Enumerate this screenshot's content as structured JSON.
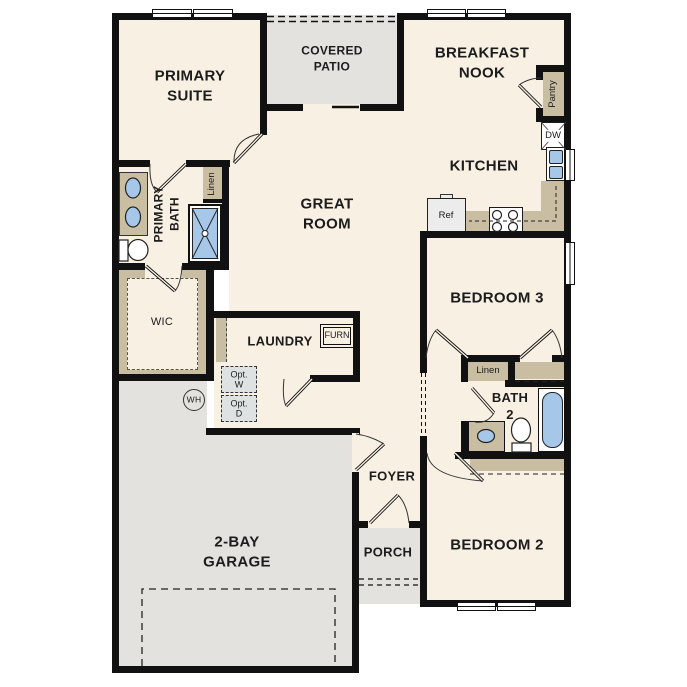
{
  "plan_title": "Single-story floor plan",
  "rooms": {
    "primary_suite": "PRIMARY\nSUITE",
    "covered_patio": "COVERED\nPATIO",
    "breakfast_nook": "BREAKFAST\nNOOK",
    "kitchen": "KITCHEN",
    "great_room": "GREAT\nROOM",
    "primary_bath": "PRIMARY\nBATH",
    "wic": "WIC",
    "laundry": "LAUNDRY",
    "bedroom3": "BEDROOM 3",
    "bath2": "BATH\n2",
    "bedroom2": "BEDROOM 2",
    "foyer": "FOYER",
    "porch": "PORCH",
    "garage": "2-BAY\nGARAGE"
  },
  "features": {
    "pantry": "Pantry",
    "dishwasher": "DW",
    "refrigerator": "Ref",
    "furnace": "FURN",
    "linen_primary": "Linen",
    "linen_hall": "Linen",
    "opt_washer": "Opt.\nW",
    "opt_dryer": "Opt.\nD",
    "water_heater": "WH"
  },
  "colors": {
    "floor": "#f8f0e3",
    "outdoor_concrete": "#e3e2df",
    "wall": "#111111",
    "casework_tan": "#c9bda2",
    "fixture_blue": "#a6c7e8",
    "optional_box": "#dfe2e2",
    "text": "#1c1c1c"
  }
}
